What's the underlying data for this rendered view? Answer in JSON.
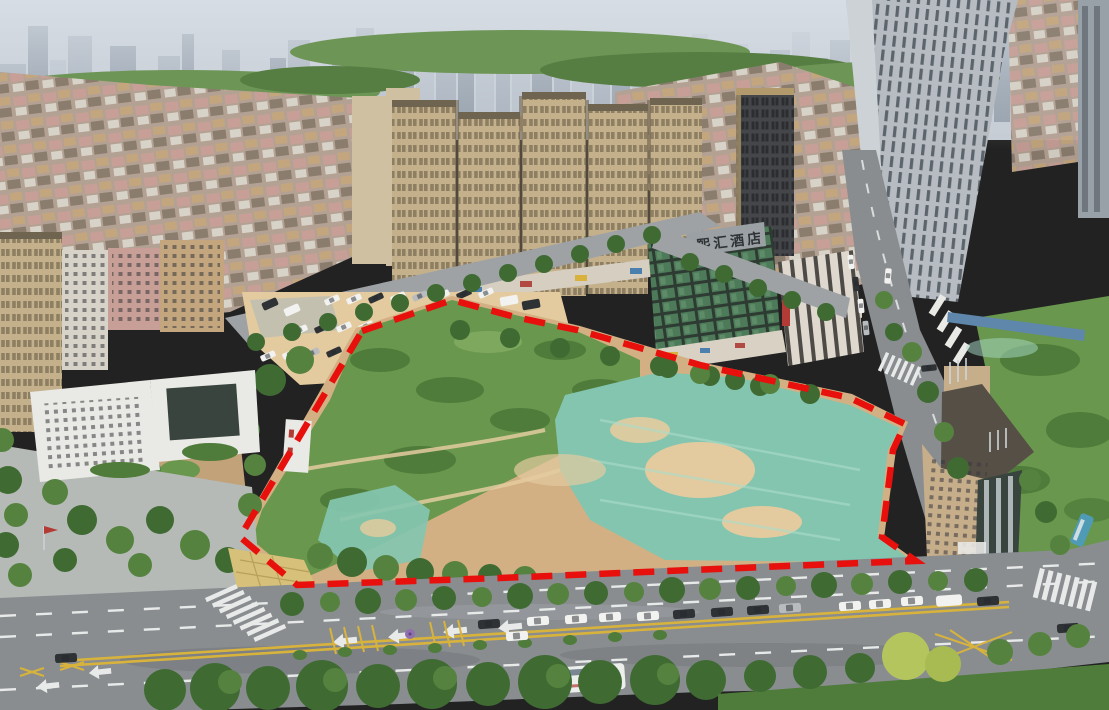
{
  "scene": {
    "type": "aerial-drone-photograph",
    "alt": "Aerial view of a vacant land parcel outlined with a red dashed boundary, partly covered by green dust-control netting and bare soil, surrounded by dense high-rise apartment blocks, an urban village, a hotel, and a wide wet arterial road with traffic",
    "hotel_sign_text": "熙汇酒店"
  },
  "boundary": {
    "color": "#e8100c",
    "style": "dashed",
    "path": "M362,331 L452,300 L515,317 L577,330 L700,365 L850,398 L905,424 L893,450 L882,537 L916,561 L860,563 L500,578 L297,585 L240,537 Z"
  },
  "palette": {
    "haze": "#c6ccd4",
    "skyA": "#a7b0bc",
    "skyB": "#b8c0ca",
    "skyC": "#949fab",
    "belt": "#6d9556",
    "beltDark": "#567e42",
    "treeDark": "#3f6b33",
    "treeMid": "#55833f",
    "treeLight": "#83ad63",
    "uvBase": "#b3a193",
    "uvPink": "#c79f97",
    "uvTan": "#c3a67e",
    "uvWhite": "#d8d3c8",
    "uvRoof": "#8a7d6e",
    "towerBeige": "#c4b18c",
    "towerWin": "#8e7f63",
    "towerTop": "#6f644f",
    "towerPale": "#cfc0a2",
    "darkTower": "#45464a",
    "darkWin": "#2c2d31",
    "goldTrim": "#b29a6d",
    "hotelFrame": "#2e3b33",
    "hotelGlass": "#4d7a58",
    "hotelGlassLight": "#6f9e78",
    "signBoard": "#9aa0a4",
    "signText": "#2f3335",
    "stripeWhite": "#ded8cf",
    "stripeDark": "#4e4a45",
    "grayTower": "#b6bcc1",
    "graySlot": "#5c646c",
    "grayLight": "#ccd2d6",
    "road": "#898d90",
    "roadLight": "#9ea2a5",
    "roadDark": "#6e7275",
    "laneWhite": "#e8eae9",
    "laneYellow": "#d8b33c",
    "dirt": "#d3b083",
    "dirtLight": "#e3cb9f",
    "shrub": "#69974d",
    "shrubDark": "#4f7c3a",
    "teal": "#84c5b0",
    "tealLight": "#aadcca",
    "plaza": "#b5bab6",
    "paveYellow": "#d6c07a",
    "white": "#e9e9e5",
    "glassDark": "#39443f",
    "carWhite": "#f2f3f1",
    "carDark": "#2f3235",
    "carSilver": "#b9bcbe",
    "busWhite": "#eceeec",
    "blueFence": "#5f87ac",
    "umbrella": "#8f6fae",
    "tanWall": "#c6ae8a",
    "tanRoof": "#564f46",
    "yellowTree": "#b5c55e",
    "redAccent": "#b23b36",
    "blueBus": "#4f9bb5",
    "boundaryRed": "#e8100c"
  }
}
